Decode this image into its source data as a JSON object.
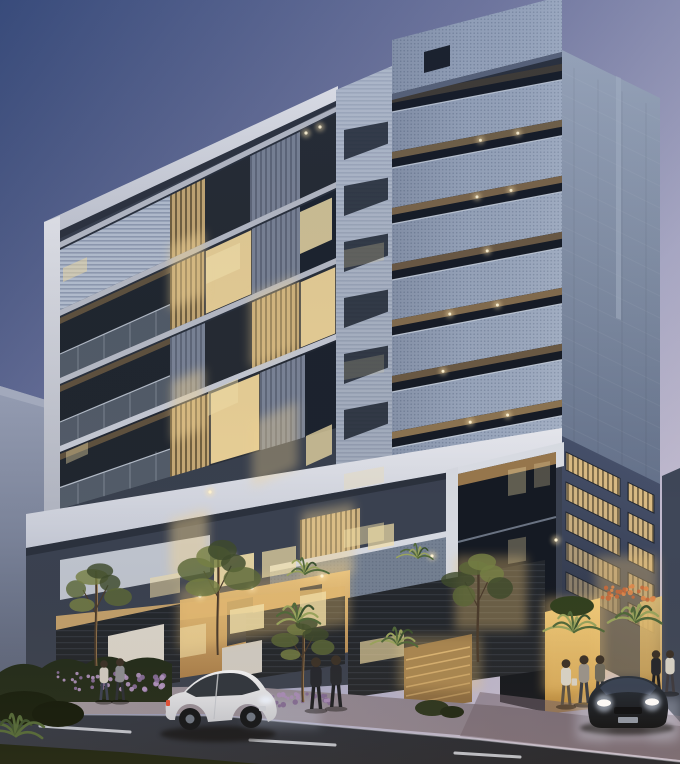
{
  "scene": {
    "type": "architectural-render-dusk",
    "colors": {
      "sky-top": "#3A4C7B",
      "sky-mid": "#767BA2",
      "sky-right": "#AEADC9",
      "sky-low": "#C7BFD1",
      "neighbor-top": "#98A0B6",
      "neighbor-bottom": "#555E74",
      "right-sliver": "#3F4758",
      "wing-base": "#39404E",
      "white-frame": "#E8E9EF",
      "white-frame-dim": "#C2C6D2",
      "charcoal": "#262B33",
      "charcoal-dark": "#1F232A",
      "mesh-base": "#9FACC2",
      "mesh-dot": "#8290A8",
      "louv-warm": "#E2C186",
      "louv-warm-stripe": "#6B5A3A",
      "louv-cool": "#8C97AC",
      "louv-cool-stripe": "#6B7488",
      "louv-h": "#B7C1D2",
      "louv-h-stripe": "#929DB3",
      "side-top": "#9FABBF",
      "side-bottom": "#64718A",
      "side-low-top": "#46506A",
      "side-low-bottom": "#2E3546",
      "window-dark": "#1C232E",
      "window-lit": "#F2DFA8",
      "ceiling-warm": "#C19A64",
      "recess-dark": "#161B25",
      "light-dot": "#FFE6AE",
      "warm-wall": "#E3BE7E",
      "warm-wall-deep": "#A97F4C",
      "yellow-wall": "#E8C068",
      "yellow-wall-deep": "#B98A3E",
      "fence": "#23272D",
      "planter-white": "#D8D3C9",
      "sidewalk": "#9E97A0",
      "sidewalk-deep": "#7E7582",
      "road": "#333B4A",
      "road-deep": "#20242E",
      "lane-dash": "#D4DAE6",
      "grass": "#1A2314",
      "hedge": "#222C1C",
      "foliage-1": "#3E4A2C",
      "foliage-2": "#5C6838",
      "foliage-3": "#768044",
      "palm": "#51693B",
      "palm-lit": "#9AA45E",
      "trunk": "#4A3B2C",
      "flower-purple": "#8A6FA0",
      "flower-purple-2": "#B095C2",
      "flower-orange": "#D3743F",
      "car-white": "#F2F3F6",
      "car-white-shade": "#C6CAD3",
      "car-glass": "#1E2630",
      "sedan-top": "#2A3340",
      "sedan-body": "#11151C",
      "headlight": "#E6EFFF",
      "taillight": "#E05038"
    },
    "tower_front": {
      "x1": 392,
      "x2": 562,
      "slope": -0.19,
      "row_top0": 112,
      "pitch": 56,
      "mesh_h": 40,
      "rows": [
        {
          "lights": [],
          "ceil": 0.25
        },
        {
          "lights": [
            0.52,
            0.74
          ],
          "ceil": 0.55
        },
        {
          "lights": [
            0.5,
            0.7
          ],
          "ceil": 0.6
        },
        {
          "lights": [
            0.56
          ],
          "ceil": 0.5
        },
        {
          "lights": [
            0.34,
            0.62
          ],
          "ceil": 0.65
        },
        {
          "lights": [
            0.3
          ],
          "ceil": 0.5
        },
        {
          "lights": [
            0.46,
            0.68
          ],
          "ceil": 0.7
        }
      ]
    },
    "wing": {
      "x1": 60,
      "x2": 336,
      "floor_tops": [
        [
          242,
          106
        ],
        [
          310,
          182
        ],
        [
          378,
          258
        ],
        [
          446,
          334
        ]
      ],
      "floor_bottoms": [
        [
          310,
          182
        ],
        [
          378,
          258
        ],
        [
          446,
          334
        ],
        [
          509,
          428
        ]
      ],
      "sliver": {
        "top": [
          446,
          334
        ],
        "bottom": [
          509,
          428
        ]
      },
      "zone_matrix": [
        [
          [
            60,
            170,
            "lvh"
          ],
          [
            170,
            205,
            "lvw"
          ],
          [
            205,
            250,
            "chc"
          ],
          [
            250,
            300,
            "lvc"
          ],
          [
            300,
            336,
            "chc"
          ]
        ],
        [
          [
            60,
            170,
            "bal"
          ],
          [
            170,
            205,
            "lvw"
          ],
          [
            205,
            252,
            "winlit"
          ],
          [
            252,
            300,
            "lvc"
          ],
          [
            300,
            336,
            "win"
          ]
        ],
        [
          [
            60,
            170,
            "bal"
          ],
          [
            170,
            205,
            "lvc"
          ],
          [
            205,
            252,
            "chc"
          ],
          [
            252,
            300,
            "lvw"
          ],
          [
            300,
            336,
            "winlit"
          ]
        ],
        [
          [
            60,
            170,
            "bal"
          ],
          [
            170,
            205,
            "lvw"
          ],
          [
            205,
            252,
            "win"
          ],
          [
            252,
            300,
            "lvc"
          ],
          [
            300,
            336,
            "chc"
          ]
        ]
      ]
    },
    "side_windows": {
      "cols": [
        [
          4,
          58
        ],
        [
          66,
          92
        ]
      ],
      "row_y0": 450,
      "pitch": 30,
      "h": 18,
      "opacity": [
        0.95,
        0.9,
        0.85,
        0.7,
        0.5
      ]
    },
    "left_col_slots": {
      "x": 344,
      "w": 44,
      "y0": 130,
      "pitch": 56,
      "count": 8,
      "slope": -0.19
    },
    "lit_windows": [
      {
        "x": 206,
        "y": 258,
        "w": 34,
        "h": 26,
        "s": -0.45,
        "o": 0.8
      },
      {
        "x": 300,
        "y": 212,
        "w": 32,
        "h": 42,
        "s": -0.45,
        "o": 0.85
      },
      {
        "x": 63,
        "y": 268,
        "w": 24,
        "h": 14,
        "s": -0.45,
        "o": 0.55
      },
      {
        "x": 208,
        "y": 392,
        "w": 30,
        "h": 24,
        "s": -0.45,
        "o": 0.5
      },
      {
        "x": 306,
        "y": 436,
        "w": 26,
        "h": 30,
        "s": -0.45,
        "o": 0.75
      },
      {
        "x": 66,
        "y": 452,
        "w": 22,
        "h": 12,
        "s": -0.45,
        "o": 0.4
      },
      {
        "x": 214,
        "y": 560,
        "w": 40,
        "h": 28,
        "s": -0.18,
        "o": 0.9
      },
      {
        "x": 262,
        "y": 552,
        "w": 34,
        "h": 26,
        "s": -0.18,
        "o": 0.7
      },
      {
        "x": 150,
        "y": 578,
        "w": 30,
        "h": 20,
        "s": -0.18,
        "o": 0.55
      },
      {
        "x": 368,
        "y": 528,
        "w": 26,
        "h": 22,
        "s": -0.18,
        "o": 0.7
      },
      {
        "x": 230,
        "y": 610,
        "w": 34,
        "h": 24,
        "s": -0.18,
        "o": 0.85
      },
      {
        "x": 300,
        "y": 596,
        "w": 26,
        "h": 34,
        "s": -0.18,
        "o": 0.8
      },
      {
        "x": 360,
        "y": 642,
        "w": 44,
        "h": 22,
        "s": -0.18,
        "o": 0.65
      },
      {
        "x": 180,
        "y": 628,
        "w": 26,
        "h": 30,
        "s": -0.18,
        "o": 0.6
      },
      {
        "x": 344,
        "y": 250,
        "w": 40,
        "h": 18,
        "s": -0.19,
        "o": 0.25
      },
      {
        "x": 344,
        "y": 362,
        "w": 40,
        "h": 18,
        "s": -0.19,
        "o": 0.2
      },
      {
        "x": 344,
        "y": 474,
        "w": 40,
        "h": 16,
        "s": -0.19,
        "o": 0.3
      },
      {
        "x": 344,
        "y": 530,
        "w": 40,
        "h": 18,
        "s": -0.19,
        "o": 0.5
      },
      {
        "x": 508,
        "y": 470,
        "w": 18,
        "h": 26,
        "s": -0.18,
        "o": 0.35
      },
      {
        "x": 534,
        "y": 464,
        "w": 16,
        "h": 24,
        "s": -0.18,
        "o": 0.28
      },
      {
        "x": 508,
        "y": 540,
        "w": 18,
        "h": 24,
        "s": -0.18,
        "o": 0.3
      }
    ],
    "glows": [
      {
        "x": 170,
        "y": 246,
        "w": 34,
        "h": 64,
        "s": -0.45,
        "o": 0.5,
        "c": "#F4D594"
      },
      {
        "x": 250,
        "y": 296,
        "w": 46,
        "h": 72,
        "s": -0.45,
        "o": 0.4,
        "c": "#F4D594"
      },
      {
        "x": 172,
        "y": 382,
        "w": 32,
        "h": 60,
        "s": -0.45,
        "o": 0.45,
        "c": "#F4D594"
      },
      {
        "x": 252,
        "y": 422,
        "w": 46,
        "h": 66,
        "s": -0.45,
        "o": 0.35,
        "c": "#F4D594"
      },
      {
        "x": 170,
        "y": 520,
        "w": 38,
        "h": 58,
        "s": -0.3,
        "o": 0.45,
        "c": "#F4D594"
      },
      {
        "x": 302,
        "y": 512,
        "w": 52,
        "h": 70,
        "s": -0.18,
        "o": 0.4,
        "c": "#F4D594"
      },
      {
        "x": 455,
        "y": 556,
        "w": 72,
        "h": 74,
        "s": 0,
        "o": 0.35,
        "c": "#F2C878"
      },
      {
        "x": 398,
        "y": 636,
        "w": 84,
        "h": 54,
        "s": 0,
        "o": 0.3,
        "c": "#F2C878"
      },
      {
        "x": 543,
        "y": 598,
        "w": 60,
        "h": 94,
        "s": 0,
        "o": 0.42,
        "c": "#F2C878"
      },
      {
        "x": 596,
        "y": 556,
        "w": 62,
        "h": 124,
        "s": 0,
        "o": 0.35,
        "c": "#F2C878"
      },
      {
        "x": 178,
        "y": 588,
        "w": 172,
        "h": 62,
        "s": -0.15,
        "o": 0.35,
        "c": "#F2C878"
      },
      {
        "x": 246,
        "y": 698,
        "w": 74,
        "h": 30,
        "s": 0,
        "o": 0.22,
        "c": "#CFE0FF"
      },
      {
        "x": 576,
        "y": 698,
        "w": 104,
        "h": 42,
        "s": 0,
        "o": 0.3,
        "c": "#DFE9FF"
      }
    ],
    "ceiling_dots": [
      {
        "x": 306,
        "y": 133
      },
      {
        "x": 320,
        "y": 127
      },
      {
        "x": 210,
        "y": 492
      },
      {
        "x": 232,
        "y": 556
      },
      {
        "x": 200,
        "y": 596
      },
      {
        "x": 252,
        "y": 588
      },
      {
        "x": 322,
        "y": 576
      },
      {
        "x": 432,
        "y": 556
      },
      {
        "x": 556,
        "y": 540
      }
    ],
    "lane_dashes": [
      [
        40,
        726,
        130,
        732
      ],
      [
        250,
        740,
        335,
        745
      ],
      [
        455,
        753,
        520,
        757
      ]
    ],
    "trees": [
      {
        "x": 96,
        "y": 666,
        "h": 95,
        "s": 1.0,
        "lit": true
      },
      {
        "x": 218,
        "y": 655,
        "h": 105,
        "s": 1.1,
        "lit": true
      },
      {
        "x": 303,
        "y": 702,
        "h": 78,
        "s": 0.9,
        "lit": true
      },
      {
        "x": 478,
        "y": 662,
        "h": 100,
        "s": 1.0,
        "lit": false
      }
    ],
    "palms": [
      {
        "x": 298,
        "y": 622,
        "s": 1.0,
        "lit": true
      },
      {
        "x": 398,
        "y": 645,
        "s": 0.9,
        "lit": true
      },
      {
        "x": 305,
        "y": 574,
        "s": 0.8,
        "lit": true
      },
      {
        "x": 418,
        "y": 558,
        "s": 0.7,
        "lit": true
      },
      {
        "x": 574,
        "y": 632,
        "s": 1.0,
        "lit": true
      },
      {
        "x": 636,
        "y": 622,
        "s": 1.1,
        "lit": true
      },
      {
        "x": 16,
        "y": 736,
        "s": 1.2,
        "lit": false
      }
    ],
    "flower_beds": [
      {
        "x": 58,
        "y": 672,
        "w": 106,
        "h": 18,
        "n": 46,
        "c1": "#8A6FA0",
        "c2": "#B095C2"
      },
      {
        "x": 266,
        "y": 694,
        "w": 64,
        "h": 12,
        "n": 30,
        "c1": "#7E6794",
        "c2": "#A58BB8"
      },
      {
        "x": 596,
        "y": 586,
        "w": 58,
        "h": 14,
        "n": 26,
        "c1": "#C96A3C",
        "c2": "#E08A4C"
      }
    ],
    "people": [
      {
        "name": "pedestrian-woman-left",
        "x": 104,
        "y": 700,
        "h": 40,
        "top": "#CFC9C2",
        "bot": "#3A4154"
      },
      {
        "name": "pedestrian-man-left",
        "x": 120,
        "y": 700,
        "h": 42,
        "top": "#8A8C92",
        "bot": "#2A2E36"
      },
      {
        "name": "businessman-1",
        "x": 316,
        "y": 709,
        "h": 52,
        "top": "#23262E",
        "bot": "#1B1E24"
      },
      {
        "name": "businessman-2",
        "x": 336,
        "y": 707,
        "h": 52,
        "top": "#25282F",
        "bot": "#1C1F25"
      },
      {
        "name": "pedestrian-woman-entrance",
        "x": 566,
        "y": 705,
        "h": 46,
        "top": "#D9D4C9",
        "bot": "#5A5146",
        "bag": true
      },
      {
        "name": "pedestrian-man-entrance-1",
        "x": 584,
        "y": 703,
        "h": 48,
        "top": "#9A948C",
        "bot": "#3A3E46"
      },
      {
        "name": "pedestrian-man-entrance-2",
        "x": 600,
        "y": 701,
        "h": 46,
        "top": "#6E6B5E",
        "bot": "#2E3138"
      },
      {
        "name": "pedestrian-far-right-1",
        "x": 656,
        "y": 694,
        "h": 44,
        "top": "#24262C",
        "bot": "#1A1C22"
      },
      {
        "name": "pedestrian-far-right-2",
        "x": 670,
        "y": 692,
        "h": 42,
        "top": "#D6D2C8",
        "bot": "#3C3A40"
      }
    ]
  }
}
